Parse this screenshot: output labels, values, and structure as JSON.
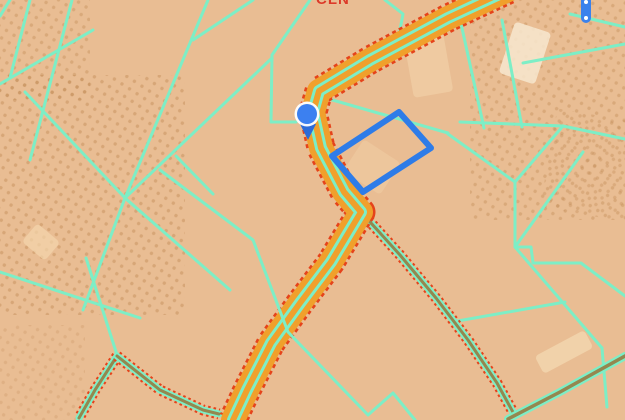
{
  "map": {
    "label": {
      "text": "CLN",
      "color": "#dc3a28",
      "x": 316,
      "y": -8
    },
    "colors": {
      "background": "#e9bd93",
      "parcel_line": "#7deec6",
      "route_fill": "#f0a02c",
      "route_border": "#e5431b",
      "road_center_olive": "#94874f",
      "selection_blue": "#2e7ce8",
      "marker_blue": "#3c80f0",
      "marker_tail_blue": "#2c6bd8",
      "handle_blue": "#3b82ec",
      "orchard_dot": "#c08a55",
      "light_field": "#f6e3c6"
    },
    "orchard_patches": [
      {
        "x": -15,
        "y": 75,
        "w": 200,
        "h": 240,
        "rot": 0,
        "opacity": 0.45
      },
      {
        "x": -10,
        "y": -10,
        "w": 100,
        "h": 110,
        "rot": 0,
        "opacity": 0.4
      },
      {
        "x": 470,
        "y": -15,
        "w": 165,
        "h": 235,
        "rot": 0,
        "opacity": 0.4
      },
      {
        "x": 548,
        "y": 115,
        "w": 85,
        "h": 100,
        "rot": 10,
        "opacity": 0.35
      },
      {
        "x": -10,
        "y": 325,
        "w": 95,
        "h": 100,
        "rot": 0,
        "opacity": 0.25
      }
    ],
    "light_patches": [
      {
        "x": 408,
        "y": 30,
        "w": 40,
        "h": 65,
        "rot": -10,
        "fill": "#f0cfa6",
        "opacity": 0.75
      },
      {
        "x": 506,
        "y": 26,
        "w": 38,
        "h": 54,
        "rot": 18,
        "fill": "#f7e7cf",
        "opacity": 0.85
      },
      {
        "x": 536,
        "y": 342,
        "w": 56,
        "h": 20,
        "rot": -28,
        "fill": "#f2d6ae",
        "opacity": 0.85
      },
      {
        "x": 26,
        "y": 230,
        "w": 30,
        "h": 24,
        "rot": 40,
        "fill": "#f3d5ad",
        "opacity": 0.7
      },
      {
        "x": 350,
        "y": 148,
        "w": 44,
        "h": 38,
        "rot": 33,
        "fill": "#f0cba2",
        "opacity": 0.6
      }
    ],
    "parcel_lines": [
      [
        [
          10,
          0
        ],
        [
          0,
          16
        ]
      ],
      [
        [
          30,
          0
        ],
        [
          10,
          78
        ]
      ],
      [
        [
          72,
          0
        ],
        [
          30,
          160
        ]
      ],
      [
        [
          208,
          0
        ],
        [
          125,
          198
        ],
        [
          83,
          310
        ]
      ],
      [
        [
          125,
          198
        ],
        [
          272,
          58
        ]
      ],
      [
        [
          176,
          156
        ],
        [
          213,
          194
        ]
      ],
      [
        [
          253,
          0
        ],
        [
          193,
          40
        ]
      ],
      [
        [
          0,
          272
        ],
        [
          140,
          318
        ]
      ],
      [
        [
          0,
          84
        ],
        [
          93,
          30
        ]
      ],
      [
        [
          25,
          92
        ],
        [
          125,
          198
        ],
        [
          230,
          290
        ]
      ],
      [
        [
          310,
          0
        ],
        [
          272,
          55
        ],
        [
          271,
          122
        ],
        [
          296,
          122
        ]
      ],
      [
        [
          385,
          0
        ],
        [
          403,
          14
        ],
        [
          398,
          40
        ]
      ],
      [
        [
          86,
          258
        ],
        [
          118,
          358
        ]
      ],
      [
        [
          458,
          10
        ],
        [
          484,
          128
        ]
      ],
      [
        [
          460,
          122
        ],
        [
          563,
          126
        ]
      ],
      [
        [
          563,
          126
        ],
        [
          625,
          139
        ]
      ],
      [
        [
          563,
          126
        ],
        [
          515,
          182
        ]
      ],
      [
        [
          448,
          134
        ],
        [
          515,
          182
        ]
      ],
      [
        [
          515,
          182
        ],
        [
          515,
          247
        ]
      ],
      [
        [
          515,
          247
        ],
        [
          531,
          247
        ],
        [
          533,
          263
        ],
        [
          581,
          263
        ],
        [
          625,
          296
        ]
      ],
      [
        [
          583,
          152
        ],
        [
          515,
          247
        ]
      ],
      [
        [
          515,
          247
        ],
        [
          602,
          348
        ]
      ],
      [
        [
          602,
          348
        ],
        [
          607,
          407
        ]
      ],
      [
        [
          523,
          63
        ],
        [
          625,
          44
        ]
      ],
      [
        [
          570,
          14
        ],
        [
          625,
          27
        ]
      ],
      [
        [
          502,
          20
        ],
        [
          522,
          127
        ]
      ],
      [
        [
          452,
          322
        ],
        [
          565,
          302
        ]
      ],
      [
        [
          322,
          97
        ],
        [
          448,
          133
        ]
      ]
    ],
    "parcel_lines_overlay": [
      [
        [
          160,
          170
        ],
        [
          253,
          240
        ],
        [
          288,
          332
        ],
        [
          368,
          415
        ],
        [
          393,
          393
        ],
        [
          415,
          420
        ]
      ]
    ],
    "thin_roads": [
      [
        [
          361,
          212
        ],
        [
          400,
          255
        ],
        [
          436,
          298
        ],
        [
          468,
          340
        ],
        [
          497,
          383
        ],
        [
          514,
          414
        ]
      ],
      [
        [
          117,
          356
        ],
        [
          95,
          390
        ],
        [
          79,
          418
        ]
      ],
      [
        [
          117,
          356
        ],
        [
          160,
          390
        ],
        [
          203,
          410
        ],
        [
          219,
          414
        ]
      ]
    ],
    "farm_track": [
      [
        508,
        419
      ],
      [
        560,
        392
      ],
      [
        625,
        356
      ]
    ],
    "route": {
      "points": [
        [
          508,
          -10
        ],
        [
          448,
          18
        ],
        [
          370,
          60
        ],
        [
          319,
          91
        ],
        [
          313,
          112
        ],
        [
          321,
          148
        ],
        [
          344,
          192
        ],
        [
          361,
          212
        ],
        [
          331,
          262
        ],
        [
          300,
          303
        ],
        [
          271,
          343
        ],
        [
          247,
          390
        ],
        [
          233,
          420
        ]
      ],
      "width": 24
    },
    "selected_parcel": {
      "points": [
        [
          399,
          112
        ],
        [
          431,
          148
        ],
        [
          363,
          192
        ],
        [
          332,
          156
        ]
      ]
    },
    "location_marker": {
      "x": 307,
      "y": 114,
      "radius": 10
    },
    "vertex_handle": {
      "x": 586,
      "y1": -8,
      "y2": 18,
      "dots": [
        [
          586,
          2
        ],
        [
          586,
          18
        ]
      ]
    }
  }
}
